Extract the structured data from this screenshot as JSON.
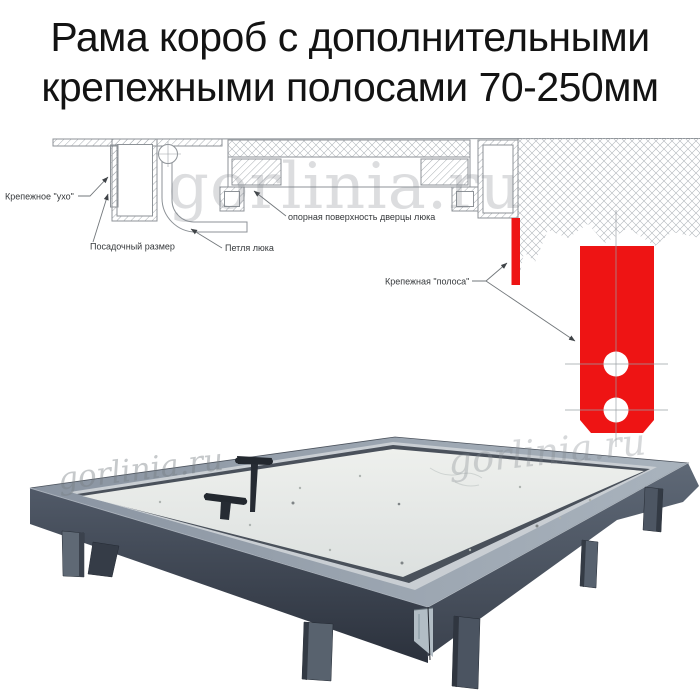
{
  "title": {
    "line1": "Рама короб с дополнительными",
    "line2": "крепежными полосами 70-250мм"
  },
  "watermark": {
    "text": "gorlinia.ru"
  },
  "diagram": {
    "labels": {
      "ear": "Крепежное \"ухо\"",
      "mounting_size": "Посадочный размер",
      "hinge": "Петля люка",
      "door_support": "опорная поверхность дверцы люка",
      "strip": "Крепежная \"полоса\""
    },
    "colors": {
      "red": "#ee1414",
      "line": "#8d9297",
      "label_text": "#35383b"
    }
  },
  "photo": {
    "colors": {
      "frame_top_band": "#98a2ae",
      "frame_front_left": "#47505e",
      "frame_front_right": "#545e6c",
      "panel": "#e9ebe8",
      "handle": "#262b33",
      "leg": "#57616e"
    }
  }
}
